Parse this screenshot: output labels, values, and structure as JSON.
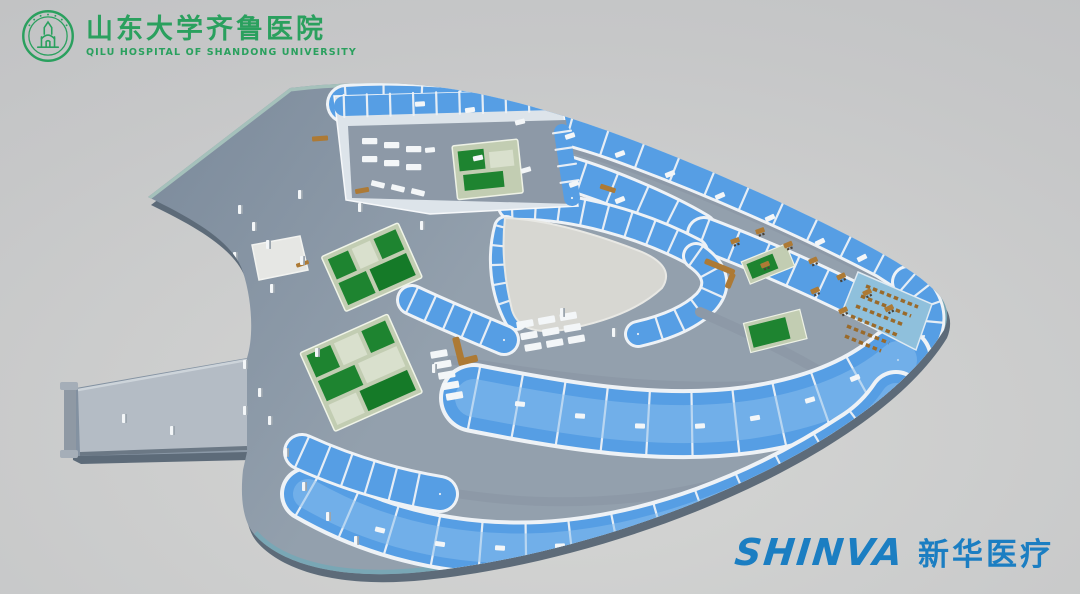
{
  "branding": {
    "hospital": {
      "emblem_icon": "qilu-hospital-seal-icon",
      "name_zh": "山东大学齐鲁医院",
      "name_en": "QILU HOSPITAL OF SHANDONG UNIVERSITY",
      "brand_color": "#2aa05e"
    },
    "vendor": {
      "wordmark": "SHINVA",
      "name_zh": "新华医疗",
      "brand_color": "#1b7ec2"
    }
  },
  "scene": {
    "palette": {
      "bg-1": "#d6d7d5",
      "bg-2": "#c6c7c8",
      "bg-3": "#bcbdbf",
      "deck-1": "#7b8a9b",
      "deck-2": "#93a0ad",
      "slab-side": "#5d6b79",
      "roof-rim": "#a5c1bb",
      "edge-rim": "#79a7b5",
      "edge-top": "#9cb8c4",
      "corridor": "#8d99a7",
      "floor-blue": "#569ee4",
      "floor-blue-light": "#8cc0ee",
      "wall-white": "#eef2f6",
      "atrium": "#d7d7d2",
      "floor-green": "#1e8430",
      "floor-green-dk": "#157a28",
      "wall-sage": "#c2cdb2",
      "wall-sage-lt": "#d9e0cd",
      "furniture-brown": "#ad7a35",
      "seat-brown": "#9a6a2a",
      "bench-white": "#f3f6f8",
      "pillar-shadow": "#9aa4ad",
      "tip-floor": "#8fc0dc",
      "arm-top": "#b4bcc5"
    }
  }
}
